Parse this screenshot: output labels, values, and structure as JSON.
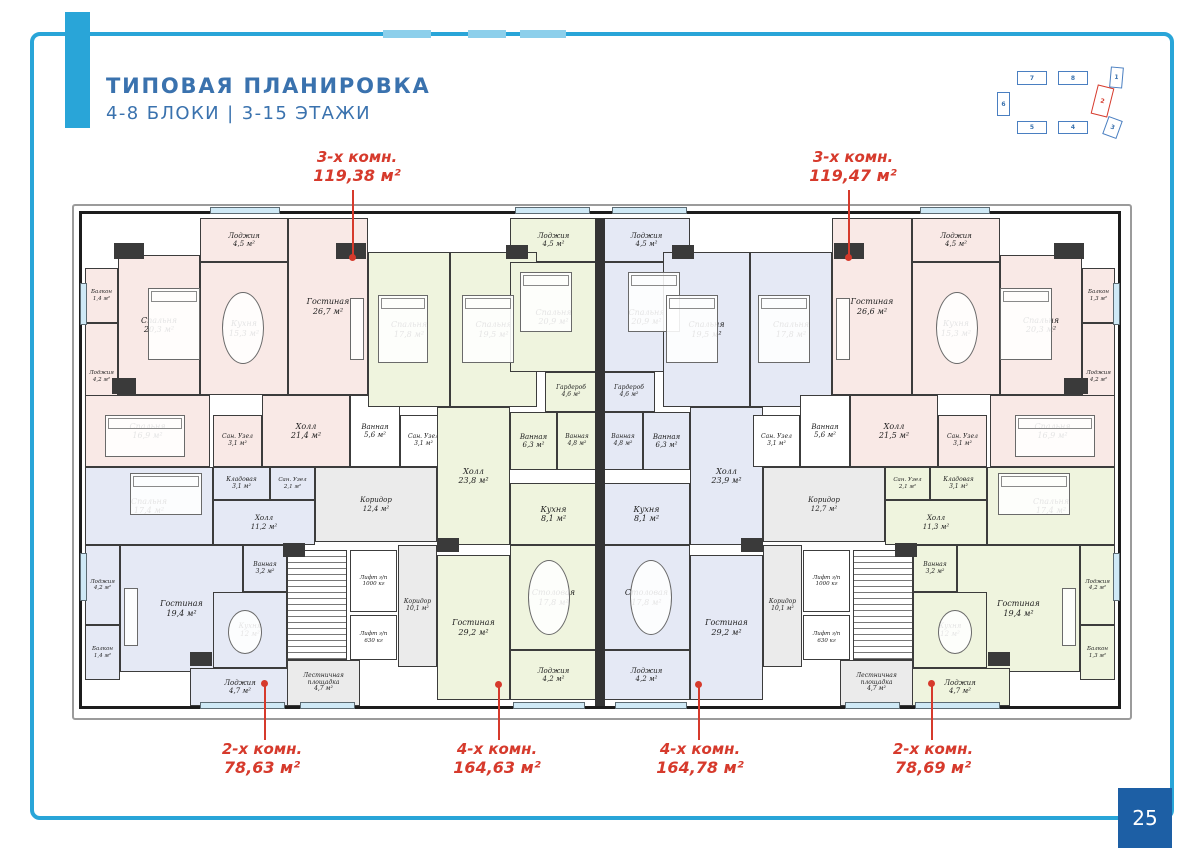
{
  "page": {
    "title_line1": "ТИПОВАЯ ПЛАНИРОВКА",
    "title_line2": "4-8 БЛОКИ | 3-15 ЭТАЖИ",
    "page_number": "25"
  },
  "colors": {
    "accent_blue": "#29a5d8",
    "title_blue": "#3a72ae",
    "annotation_red": "#d63a2c",
    "pagebox_blue": "#1d5fa5",
    "apt_pink": "#f9e9e6",
    "apt_green": "#eff4de",
    "apt_blue": "#e5e9f5",
    "common_gray": "#ebebeb"
  },
  "site_map": {
    "active_block": "2",
    "blocks": [
      {
        "n": "7",
        "x": 1017,
        "y": 71,
        "w": 30,
        "h": 14,
        "rot": 0,
        "red": false
      },
      {
        "n": "8",
        "x": 1058,
        "y": 71,
        "w": 30,
        "h": 14,
        "rot": 0,
        "red": false
      },
      {
        "n": "1",
        "x": 1110,
        "y": 67,
        "w": 13,
        "h": 21,
        "rot": 5,
        "red": false
      },
      {
        "n": "6",
        "x": 997,
        "y": 92,
        "w": 13,
        "h": 24,
        "rot": 0,
        "red": false
      },
      {
        "n": "2",
        "x": 1094,
        "y": 86,
        "w": 17,
        "h": 30,
        "rot": 14,
        "red": true
      },
      {
        "n": "5",
        "x": 1017,
        "y": 121,
        "w": 30,
        "h": 13,
        "rot": 0,
        "red": false
      },
      {
        "n": "4",
        "x": 1058,
        "y": 121,
        "w": 30,
        "h": 13,
        "rot": 0,
        "red": false
      },
      {
        "n": "3",
        "x": 1105,
        "y": 118,
        "w": 15,
        "h": 19,
        "rot": 20,
        "red": false
      }
    ]
  },
  "annotations": [
    {
      "line1": "3-х комн.",
      "line2": "119,38 м²",
      "tx": 292,
      "ty": 148,
      "lx": 352,
      "y1": 190,
      "y2": 257,
      "dotY": 254
    },
    {
      "line1": "3-х комн.",
      "line2": "119,47 м²",
      "tx": 788,
      "ty": 148,
      "lx": 848,
      "y1": 190,
      "y2": 257,
      "dotY": 254
    },
    {
      "line1": "2-х комн.",
      "line2": "78,63 м²",
      "tx": 197,
      "ty": 740,
      "lx": 264,
      "y1": 684,
      "y2": 740,
      "dotY": 680
    },
    {
      "line1": "4-х комн.",
      "line2": "164,63 м²",
      "tx": 432,
      "ty": 740,
      "lx": 498,
      "y1": 685,
      "y2": 740,
      "dotY": 681
    },
    {
      "line1": "4-х комн.",
      "line2": "164,78 м²",
      "tx": 635,
      "ty": 740,
      "lx": 698,
      "y1": 685,
      "y2": 740,
      "dotY": 681
    },
    {
      "line1": "2-х комн.",
      "line2": "78,69 м²",
      "tx": 868,
      "ty": 740,
      "lx": 931,
      "y1": 684,
      "y2": 740,
      "dotY": 680
    }
  ],
  "rooms": [
    {
      "name": "Лоджия",
      "area": "4,5 м²",
      "cls": "p",
      "x": 200,
      "y": 218,
      "w": 88,
      "h": 44,
      "fs": 7
    },
    {
      "name": "Гостиная",
      "area": "26,7 м²",
      "cls": "p",
      "x": 288,
      "y": 218,
      "w": 80,
      "h": 177
    },
    {
      "name": "Кухня",
      "area": "15,3 м²",
      "cls": "p",
      "x": 200,
      "y": 262,
      "w": 88,
      "h": 133
    },
    {
      "name": "Спальня",
      "area": "20,3 м²",
      "cls": "p",
      "x": 118,
      "y": 255,
      "w": 82,
      "h": 140
    },
    {
      "name": "Балкон",
      "area": "1,4 м²",
      "cls": "p",
      "x": 85,
      "y": 268,
      "w": 33,
      "h": 55,
      "fs": 5.5
    },
    {
      "name": "Лоджия",
      "area": "4,2 м²",
      "cls": "p",
      "x": 85,
      "y": 323,
      "w": 33,
      "h": 107,
      "fs": 5.5
    },
    {
      "name": "Спальня",
      "area": "16,9 м²",
      "cls": "p",
      "x": 85,
      "y": 395,
      "w": 125,
      "h": 72
    },
    {
      "name": "Сан. Узел",
      "area": "3,1 м²",
      "cls": "p",
      "x": 213,
      "y": 415,
      "w": 49,
      "h": 52,
      "fs": 6
    },
    {
      "name": "Холл",
      "area": "21,4 м²",
      "cls": "p",
      "x": 262,
      "y": 395,
      "w": 88,
      "h": 72
    },
    {
      "name": "Ванная",
      "area": "5,6 м²",
      "cls": "w",
      "x": 350,
      "y": 395,
      "w": 50,
      "h": 72,
      "fs": 7
    },
    {
      "name": "Сан. Узел",
      "area": "3,1 м²",
      "cls": "w",
      "x": 400,
      "y": 415,
      "w": 47,
      "h": 52,
      "fs": 6
    },
    {
      "name": "Лоджия",
      "area": "4,5 м²",
      "cls": "g",
      "x": 510,
      "y": 218,
      "w": 87,
      "h": 44,
      "fs": 7
    },
    {
      "name": "Спальня",
      "area": "17,8 м²",
      "cls": "g",
      "x": 368,
      "y": 252,
      "w": 82,
      "h": 155
    },
    {
      "name": "Спальня",
      "area": "19,5 м²",
      "cls": "g",
      "x": 450,
      "y": 252,
      "w": 87,
      "h": 155
    },
    {
      "name": "Спальня",
      "area": "20,9 м²",
      "cls": "g",
      "x": 510,
      "y": 262,
      "w": 87,
      "h": 110
    },
    {
      "name": "Гардероб",
      "area": "4,6 м²",
      "cls": "g",
      "x": 545,
      "y": 372,
      "w": 52,
      "h": 40,
      "fs": 6
    },
    {
      "name": "Ванная",
      "area": "6,3 м²",
      "cls": "g",
      "x": 510,
      "y": 412,
      "w": 47,
      "h": 58,
      "fs": 7
    },
    {
      "name": "Ванная",
      "area": "4,8 м²",
      "cls": "g",
      "x": 557,
      "y": 412,
      "w": 40,
      "h": 58,
      "fs": 6
    },
    {
      "name": "Холл",
      "area": "23,8 м²",
      "cls": "g",
      "x": 437,
      "y": 407,
      "w": 73,
      "h": 138
    },
    {
      "name": "Кухня",
      "area": "8,1 м²",
      "cls": "g",
      "x": 510,
      "y": 483,
      "w": 87,
      "h": 62
    },
    {
      "name": "Столовая",
      "area": "17,8 м²",
      "cls": "g",
      "x": 510,
      "y": 545,
      "w": 87,
      "h": 105
    },
    {
      "name": "Лоджия",
      "area": "4,2 м²",
      "cls": "g",
      "x": 510,
      "y": 650,
      "w": 87,
      "h": 50,
      "fs": 7
    },
    {
      "name": "Гостиная",
      "area": "29,2 м²",
      "cls": "g",
      "x": 437,
      "y": 555,
      "w": 73,
      "h": 145
    },
    {
      "name": "Коридор",
      "area": "10,1 м²",
      "cls": "c",
      "x": 398,
      "y": 545,
      "w": 39,
      "h": 122,
      "fs": 6
    },
    {
      "name": "Коридор",
      "area": "12,4 м²",
      "cls": "c",
      "x": 315,
      "y": 467,
      "w": 122,
      "h": 75,
      "fs": 7
    },
    {
      "name": "Спальня",
      "area": "17,4 м²",
      "cls": "b",
      "x": 85,
      "y": 467,
      "w": 128,
      "h": 78
    },
    {
      "name": "Кладовая",
      "area": "3,1 м²",
      "cls": "b",
      "x": 213,
      "y": 467,
      "w": 57,
      "h": 33,
      "fs": 6
    },
    {
      "name": "Сан. Узел",
      "area": "2,1 м²",
      "cls": "b",
      "x": 270,
      "y": 467,
      "w": 45,
      "h": 33,
      "fs": 5.5
    },
    {
      "name": "Холл",
      "area": "11,2 м²",
      "cls": "b",
      "x": 213,
      "y": 500,
      "w": 102,
      "h": 45,
      "fs": 7
    },
    {
      "name": "Ванная",
      "area": "3,2 м²",
      "cls": "b",
      "x": 243,
      "y": 545,
      "w": 44,
      "h": 47,
      "fs": 6
    },
    {
      "name": "Гостиная",
      "area": "19,4 м²",
      "cls": "b",
      "x": 120,
      "y": 545,
      "w": 123,
      "h": 127
    },
    {
      "name": "Лоджия",
      "area": "4,2 м²",
      "cls": "b",
      "x": 85,
      "y": 545,
      "w": 35,
      "h": 80,
      "fs": 5.5
    },
    {
      "name": "Балкон",
      "area": "1,4 м²",
      "cls": "b",
      "x": 85,
      "y": 625,
      "w": 35,
      "h": 55,
      "fs": 5.5
    },
    {
      "name": "Кухня",
      "area": "12 м²",
      "cls": "b",
      "x": 213,
      "y": 592,
      "w": 74,
      "h": 76,
      "fs": 7
    },
    {
      "name": "Лоджия",
      "area": "4,7 м²",
      "cls": "b",
      "x": 190,
      "y": 668,
      "w": 100,
      "h": 38,
      "fs": 7
    },
    {
      "name": "",
      "area": "",
      "cls": "w st",
      "x": 287,
      "y": 550,
      "w": 60,
      "h": 110,
      "dn": "stairs"
    },
    {
      "name": "Лифт г/п",
      "area": "1000 кг",
      "cls": "w",
      "x": 350,
      "y": 550,
      "w": 47,
      "h": 62,
      "fs": 5.5,
      "dn": "elevator"
    },
    {
      "name": "Лифт г/п",
      "area": "630 кг",
      "cls": "w",
      "x": 350,
      "y": 615,
      "w": 47,
      "h": 45,
      "fs": 5.5,
      "dn": "elevator"
    },
    {
      "name": "Лестничная площадка",
      "area": "4,7 м²",
      "cls": "c",
      "x": 287,
      "y": 660,
      "w": 73,
      "h": 46,
      "fs": 6,
      "dn": "stair-landing"
    },
    {
      "name": "Лоджия",
      "area": "4,5 м²",
      "cls": "b",
      "x": 603,
      "y": 218,
      "w": 87,
      "h": 44,
      "fs": 7
    },
    {
      "name": "Спальня",
      "area": "20,9 м²",
      "cls": "b",
      "x": 603,
      "y": 262,
      "w": 87,
      "h": 110
    },
    {
      "name": "Гардероб",
      "area": "4,6 м²",
      "cls": "b",
      "x": 603,
      "y": 372,
      "w": 52,
      "h": 40,
      "fs": 6
    },
    {
      "name": "Ванная",
      "area": "4,8 м²",
      "cls": "b",
      "x": 603,
      "y": 412,
      "w": 40,
      "h": 58,
      "fs": 6
    },
    {
      "name": "Ванная",
      "area": "6,3 м²",
      "cls": "b",
      "x": 643,
      "y": 412,
      "w": 47,
      "h": 58,
      "fs": 7
    },
    {
      "name": "Спальня",
      "area": "19,5 м²",
      "cls": "b",
      "x": 663,
      "y": 252,
      "w": 87,
      "h": 155
    },
    {
      "name": "Спальня",
      "area": "17,8 м²",
      "cls": "b",
      "x": 750,
      "y": 252,
      "w": 82,
      "h": 155
    },
    {
      "name": "Холл",
      "area": "23,9 м²",
      "cls": "b",
      "x": 690,
      "y": 407,
      "w": 73,
      "h": 138
    },
    {
      "name": "Кухня",
      "area": "8,1 м²",
      "cls": "b",
      "x": 603,
      "y": 483,
      "w": 87,
      "h": 62
    },
    {
      "name": "Столовая",
      "area": "17,8 м²",
      "cls": "b",
      "x": 603,
      "y": 545,
      "w": 87,
      "h": 105
    },
    {
      "name": "Лоджия",
      "area": "4,2 м²",
      "cls": "b",
      "x": 603,
      "y": 650,
      "w": 87,
      "h": 50,
      "fs": 7
    },
    {
      "name": "Гостиная",
      "area": "29,2 м²",
      "cls": "b",
      "x": 690,
      "y": 555,
      "w": 73,
      "h": 145
    },
    {
      "name": "Коридор",
      "area": "10,1 м²",
      "cls": "c",
      "x": 763,
      "y": 545,
      "w": 39,
      "h": 122,
      "fs": 6
    },
    {
      "name": "Коридор",
      "area": "12,7 м²",
      "cls": "c",
      "x": 763,
      "y": 467,
      "w": 122,
      "h": 75,
      "fs": 7
    },
    {
      "name": "Сан. Узел",
      "area": "3,1 м²",
      "cls": "w",
      "x": 753,
      "y": 415,
      "w": 47,
      "h": 52,
      "fs": 6
    },
    {
      "name": "Ванная",
      "area": "5,6 м²",
      "cls": "w",
      "x": 800,
      "y": 395,
      "w": 50,
      "h": 72,
      "fs": 7
    },
    {
      "name": "Гостиная",
      "area": "26,6 м²",
      "cls": "p",
      "x": 832,
      "y": 218,
      "w": 80,
      "h": 177
    },
    {
      "name": "Лоджия",
      "area": "4,5 м²",
      "cls": "p",
      "x": 912,
      "y": 218,
      "w": 88,
      "h": 44,
      "fs": 7
    },
    {
      "name": "Кухня",
      "area": "15,3 м²",
      "cls": "p",
      "x": 912,
      "y": 262,
      "w": 88,
      "h": 133
    },
    {
      "name": "Спальня",
      "area": "20,3 м²",
      "cls": "p",
      "x": 1000,
      "y": 255,
      "w": 82,
      "h": 140
    },
    {
      "name": "Балкон",
      "area": "1,3 м²",
      "cls": "p",
      "x": 1082,
      "y": 268,
      "w": 33,
      "h": 55,
      "fs": 5.5
    },
    {
      "name": "Лоджия",
      "area": "4,2 м²",
      "cls": "p",
      "x": 1082,
      "y": 323,
      "w": 33,
      "h": 107,
      "fs": 5.5
    },
    {
      "name": "Спальня",
      "area": "16,9 м²",
      "cls": "p",
      "x": 990,
      "y": 395,
      "w": 125,
      "h": 72
    },
    {
      "name": "Сан. Узел",
      "area": "3,1 м²",
      "cls": "p",
      "x": 938,
      "y": 415,
      "w": 49,
      "h": 52,
      "fs": 6
    },
    {
      "name": "Холл",
      "area": "21,5 м²",
      "cls": "p",
      "x": 850,
      "y": 395,
      "w": 88,
      "h": 72
    },
    {
      "name": "Спальня",
      "area": "17,4 м²",
      "cls": "g",
      "x": 987,
      "y": 467,
      "w": 128,
      "h": 78
    },
    {
      "name": "Кладовая",
      "area": "3,1 м²",
      "cls": "g",
      "x": 930,
      "y": 467,
      "w": 57,
      "h": 33,
      "fs": 6
    },
    {
      "name": "Сан. Узел",
      "area": "2,1 м²",
      "cls": "g",
      "x": 885,
      "y": 467,
      "w": 45,
      "h": 33,
      "fs": 5.5
    },
    {
      "name": "Холл",
      "area": "11,3 м²",
      "cls": "g",
      "x": 885,
      "y": 500,
      "w": 102,
      "h": 45,
      "fs": 7
    },
    {
      "name": "Ванная",
      "area": "3,2 м²",
      "cls": "g",
      "x": 913,
      "y": 545,
      "w": 44,
      "h": 47,
      "fs": 6
    },
    {
      "name": "Гостиная",
      "area": "19,4 м²",
      "cls": "g",
      "x": 957,
      "y": 545,
      "w": 123,
      "h": 127
    },
    {
      "name": "Лоджия",
      "area": "4,2 м²",
      "cls": "g",
      "x": 1080,
      "y": 545,
      "w": 35,
      "h": 80,
      "fs": 5.5
    },
    {
      "name": "Балкон",
      "area": "1,3 м²",
      "cls": "g",
      "x": 1080,
      "y": 625,
      "w": 35,
      "h": 55,
      "fs": 5.5
    },
    {
      "name": "Кухня",
      "area": "12 м²",
      "cls": "g",
      "x": 913,
      "y": 592,
      "w": 74,
      "h": 76,
      "fs": 7
    },
    {
      "name": "Лоджия",
      "area": "4,7 м²",
      "cls": "g",
      "x": 910,
      "y": 668,
      "w": 100,
      "h": 38,
      "fs": 7
    },
    {
      "name": "",
      "area": "",
      "cls": "w st",
      "x": 853,
      "y": 550,
      "w": 60,
      "h": 110,
      "dn": "stairs"
    },
    {
      "name": "Лифт г/п",
      "area": "1000 кг",
      "cls": "w",
      "x": 803,
      "y": 550,
      "w": 47,
      "h": 62,
      "fs": 5.5,
      "dn": "elevator"
    },
    {
      "name": "Лифт г/п",
      "area": "630 кг",
      "cls": "w",
      "x": 803,
      "y": 615,
      "w": 47,
      "h": 45,
      "fs": 5.5,
      "dn": "elevator"
    },
    {
      "name": "Лестничная площадка",
      "area": "4,7 м²",
      "cls": "c",
      "x": 840,
      "y": 660,
      "w": 73,
      "h": 46,
      "fs": 6,
      "dn": "stair-landing"
    }
  ]
}
